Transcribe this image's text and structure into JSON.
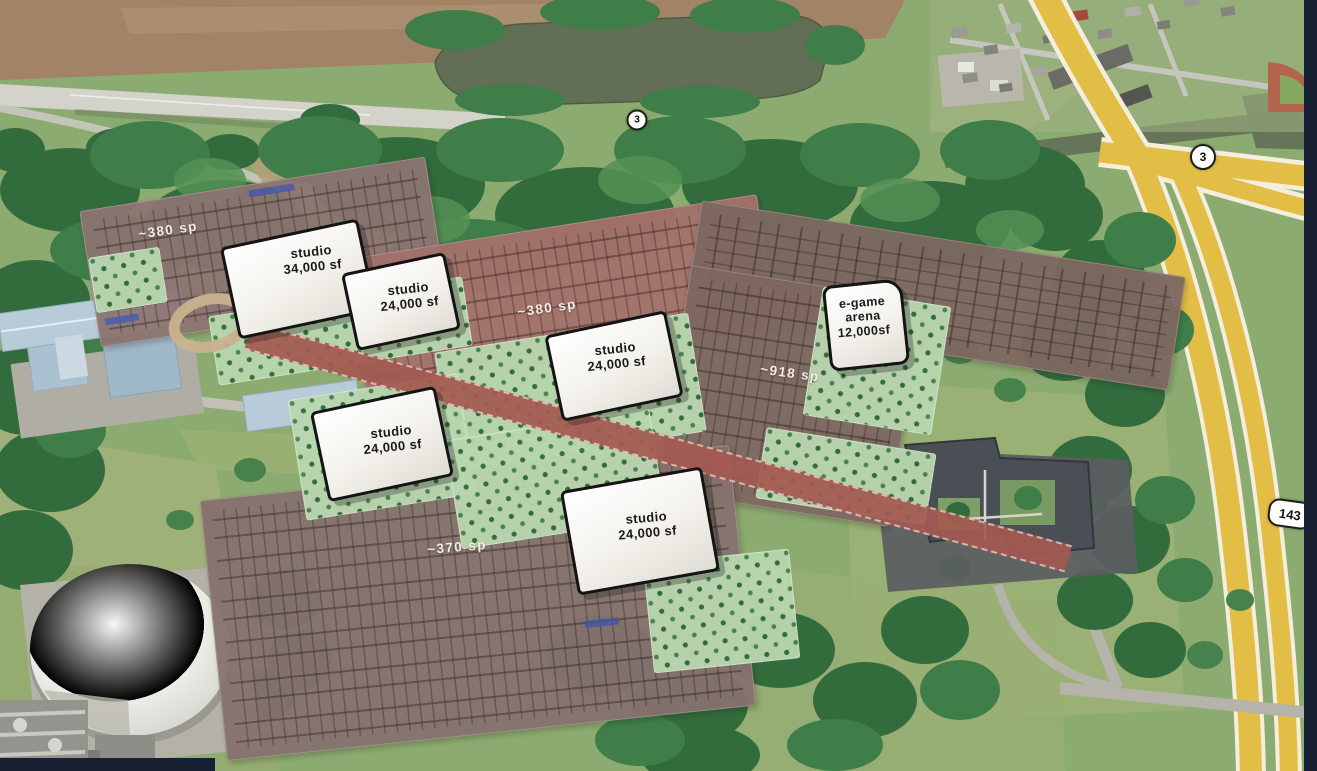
{
  "site_plan": {
    "buildings": [
      {
        "name": "studio",
        "size": "34,000 sf"
      },
      {
        "name": "studio",
        "size": "24,000 sf"
      },
      {
        "name": "studio",
        "size": "24,000 sf"
      },
      {
        "name": "studio",
        "size": "24,000 sf"
      },
      {
        "name": "studio",
        "size": "24,000 sf"
      },
      {
        "name": "e-game arena",
        "size": "12,000sf"
      }
    ],
    "parking_lots": [
      {
        "label": "~380 sp"
      },
      {
        "label": "~380 sp"
      },
      {
        "label": "~918 sp"
      },
      {
        "label": "~370 sp"
      }
    ]
  },
  "route_shields": [
    {
      "label": "3"
    },
    {
      "label": "3"
    },
    {
      "label": "143"
    }
  ],
  "colors": {
    "building-fill": "#f4f2ec",
    "building-outline": "#141414",
    "lot-nw": "#8d7472",
    "lot-n": "#a5716b",
    "lot-e": "#7e6861",
    "lot-s": "#86716e",
    "landscape-green": "#b9d7af",
    "site-road-red": "#a45a51",
    "highway-yellow": "#e2be47",
    "water": "#626e55",
    "label-on-building": "#191919",
    "label-on-parking": "#f3ece7"
  }
}
